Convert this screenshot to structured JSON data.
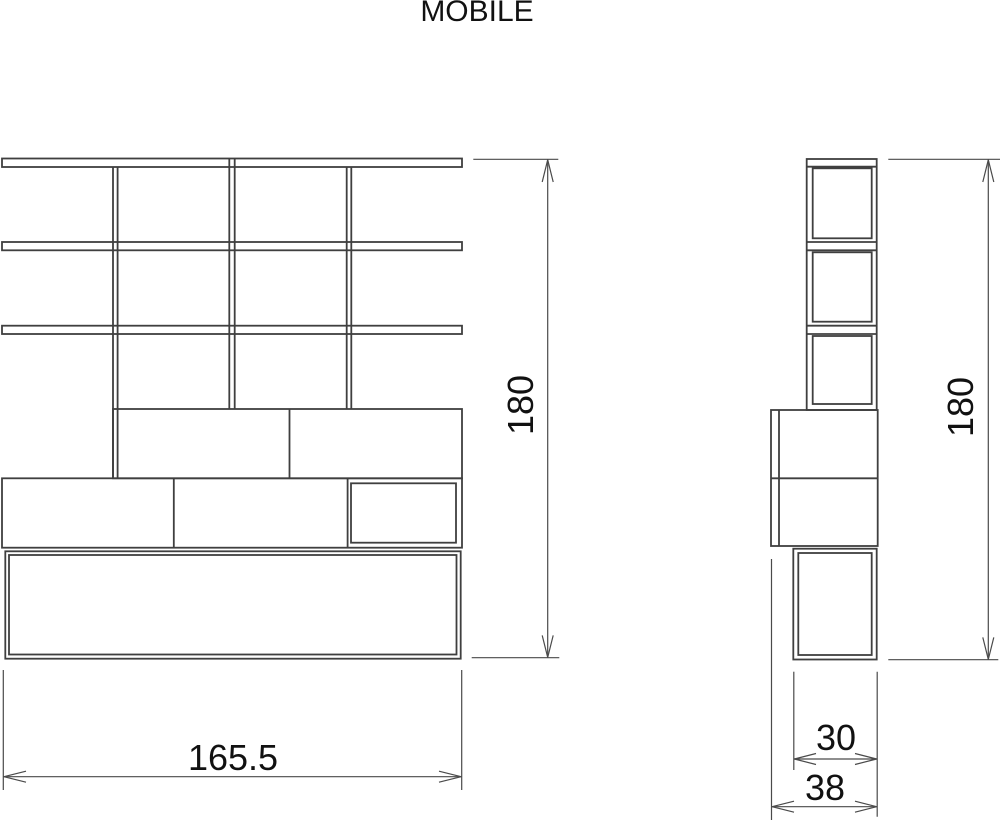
{
  "title": "MOBILE",
  "front_view": {
    "name": "front elevation",
    "height_label": "180",
    "width_label": "165.5"
  },
  "side_view": {
    "name": "side elevation",
    "height_label": "180",
    "top_depth_label": "30",
    "base_depth_label": "38"
  },
  "colors": {
    "object_line": "#3f3f3f",
    "dimension_line": "#4a4a4a",
    "text": "#111111",
    "background": "#ffffff"
  }
}
